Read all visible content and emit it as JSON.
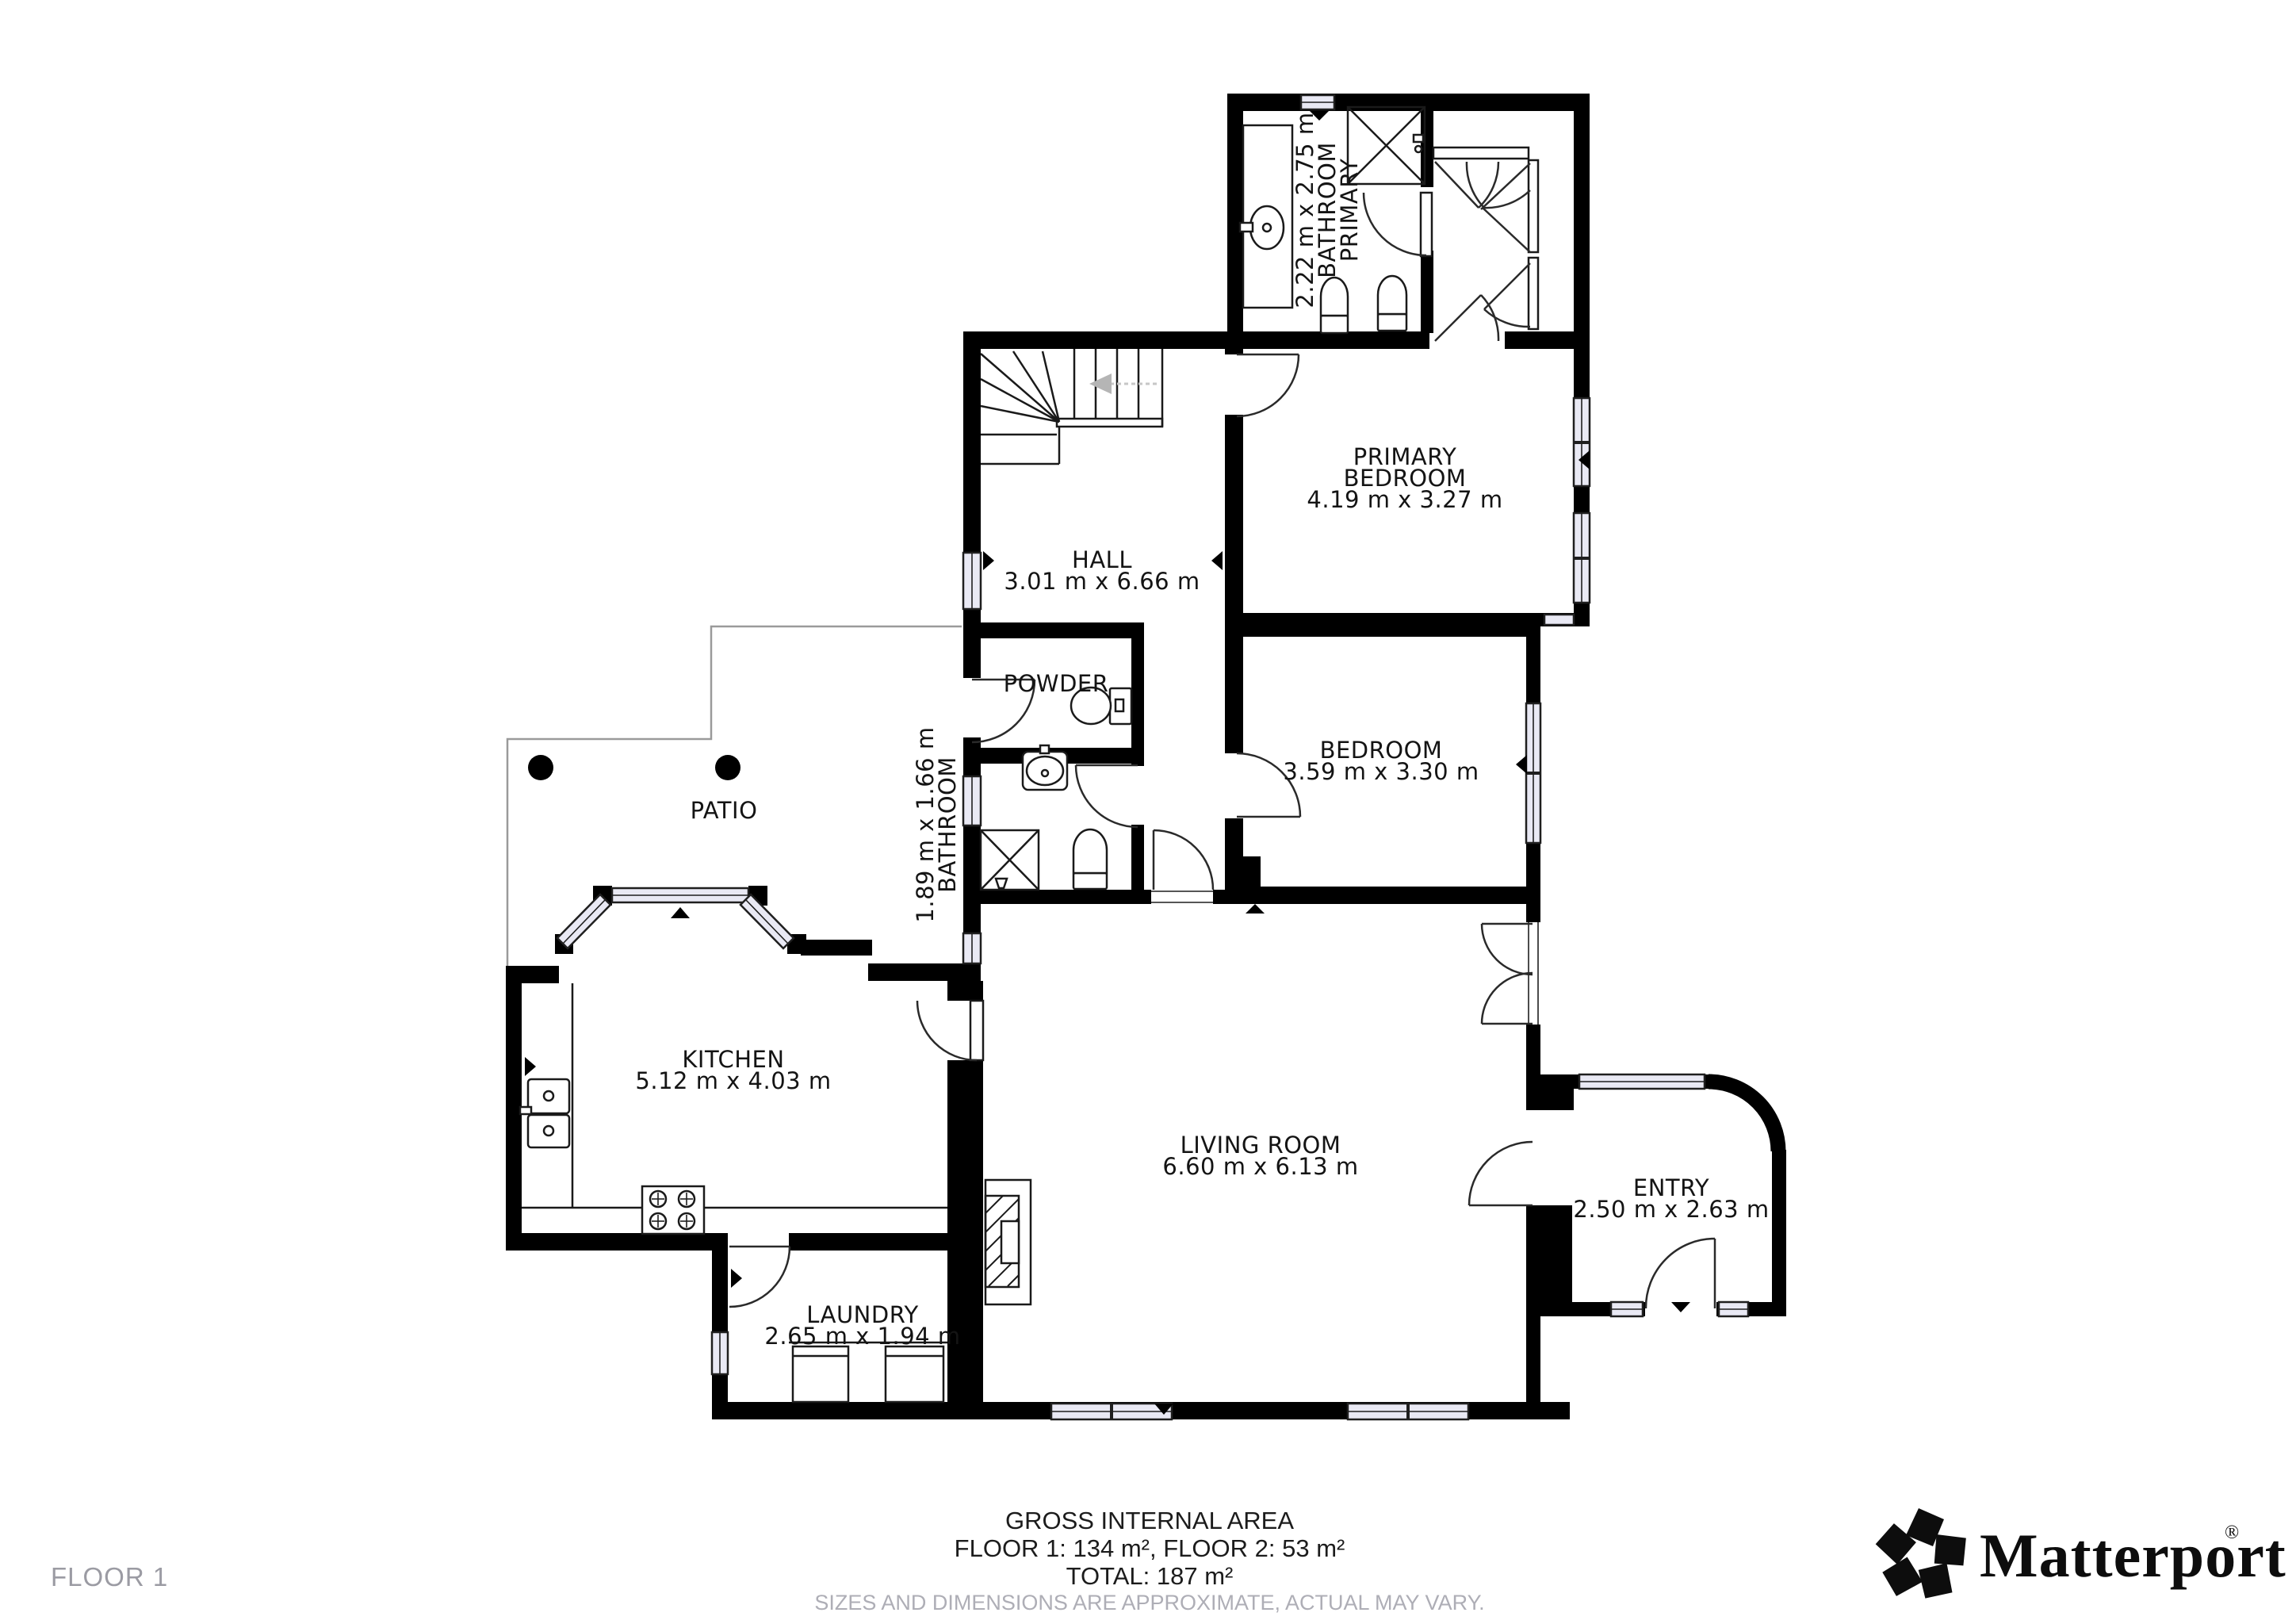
{
  "floor_label": "FLOOR 1",
  "footer": {
    "title": "GROSS INTERNAL AREA",
    "areas_line": "FLOOR 1: 134 m², FLOOR 2: 53 m²",
    "total_line": "TOTAL: 187 m²",
    "disclaimer": "SIZES AND DIMENSIONS ARE APPROXIMATE, ACTUAL MAY VARY."
  },
  "brand": {
    "wordmark": "Matterport",
    "registered": "®"
  },
  "rooms": {
    "primary_bathroom": {
      "line1": "PRIMARY",
      "line2": "BATHROOM",
      "dims": "2.22 m x 2.75 m"
    },
    "primary_bedroom": {
      "line1": "PRIMARY",
      "line2": "BEDROOM",
      "dims": "4.19 m x 3.27 m"
    },
    "hall": {
      "line1": "HALL",
      "dims": "3.01 m x 6.66 m"
    },
    "powder": {
      "line1": "POWDER"
    },
    "bathroom": {
      "line1": "BATHROOM",
      "dims": "1.89 m x 1.66 m"
    },
    "bedroom": {
      "line1": "BEDROOM",
      "dims": "3.59 m x 3.30 m"
    },
    "patio": {
      "line1": "PATIO"
    },
    "kitchen": {
      "line1": "KITCHEN",
      "dims": "5.12 m x 4.03 m"
    },
    "living_room": {
      "line1": "LIVING ROOM",
      "dims": "6.60 m x 6.13 m"
    },
    "entry": {
      "line1": "ENTRY",
      "dims": "2.50 m x 2.63 m"
    },
    "laundry": {
      "line1": "LAUNDRY",
      "dims": "2.65 m x 1.94 m"
    }
  },
  "colors": {
    "wall": "#000000",
    "window_fill": "#e9e9f4",
    "muted_text": "#9b9ba3",
    "disclaimer_text": "#aeaeb6"
  }
}
